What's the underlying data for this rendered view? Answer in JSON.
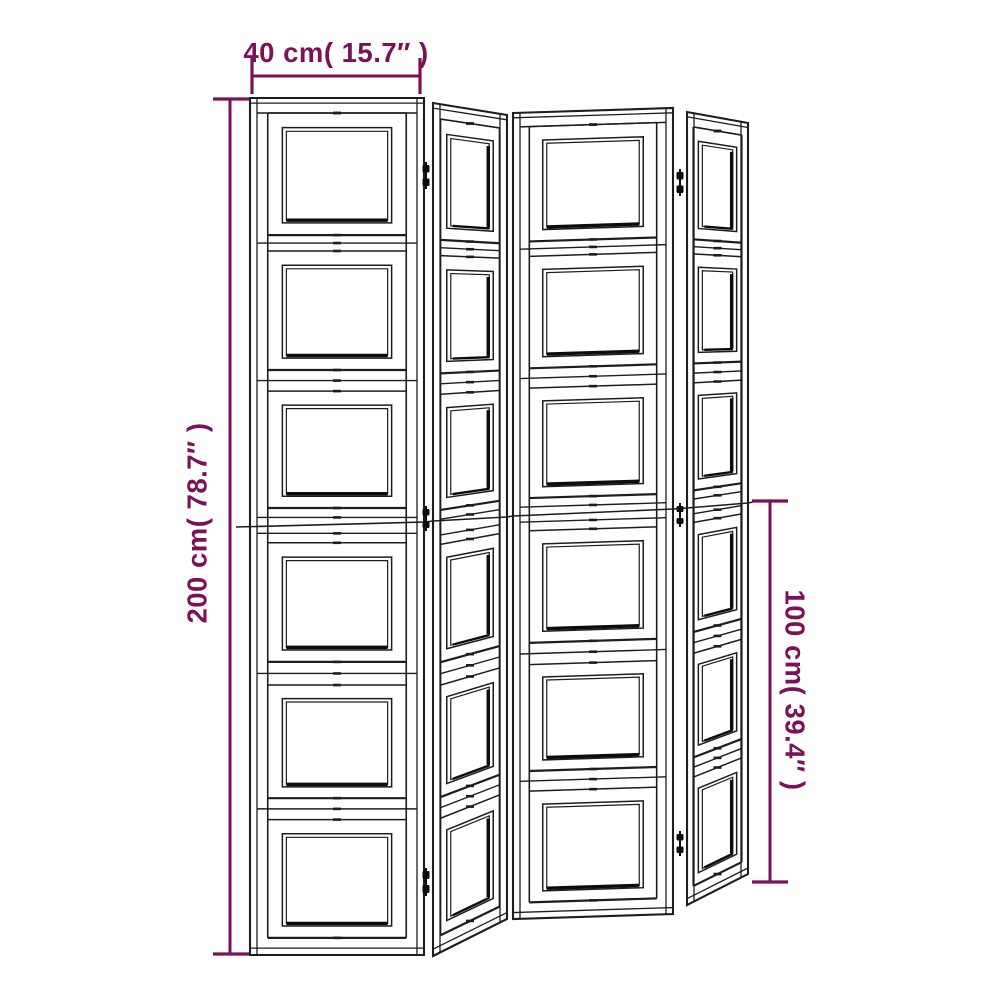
{
  "diagram": {
    "kind": "product-dimension-drawing",
    "dimensions": {
      "width": {
        "label": "40 cm( 15.7″ )",
        "value_cm": 40,
        "value_in": 15.7
      },
      "height": {
        "label": "200 cm( 78.7″ )",
        "value_cm": 200,
        "value_in": 78.7
      },
      "half_height": {
        "label": "100 cm( 39.4″ )",
        "value_cm": 100,
        "value_in": 39.4
      }
    },
    "structure": {
      "panel_count": 4,
      "cells_per_panel": 6,
      "hinge_columns": 2,
      "hinges_per_column": 3
    },
    "colors": {
      "accent": "#7c1059",
      "line": "#1d1d1d",
      "shadow": "#0c0c0c",
      "background": "#ffffff"
    }
  }
}
